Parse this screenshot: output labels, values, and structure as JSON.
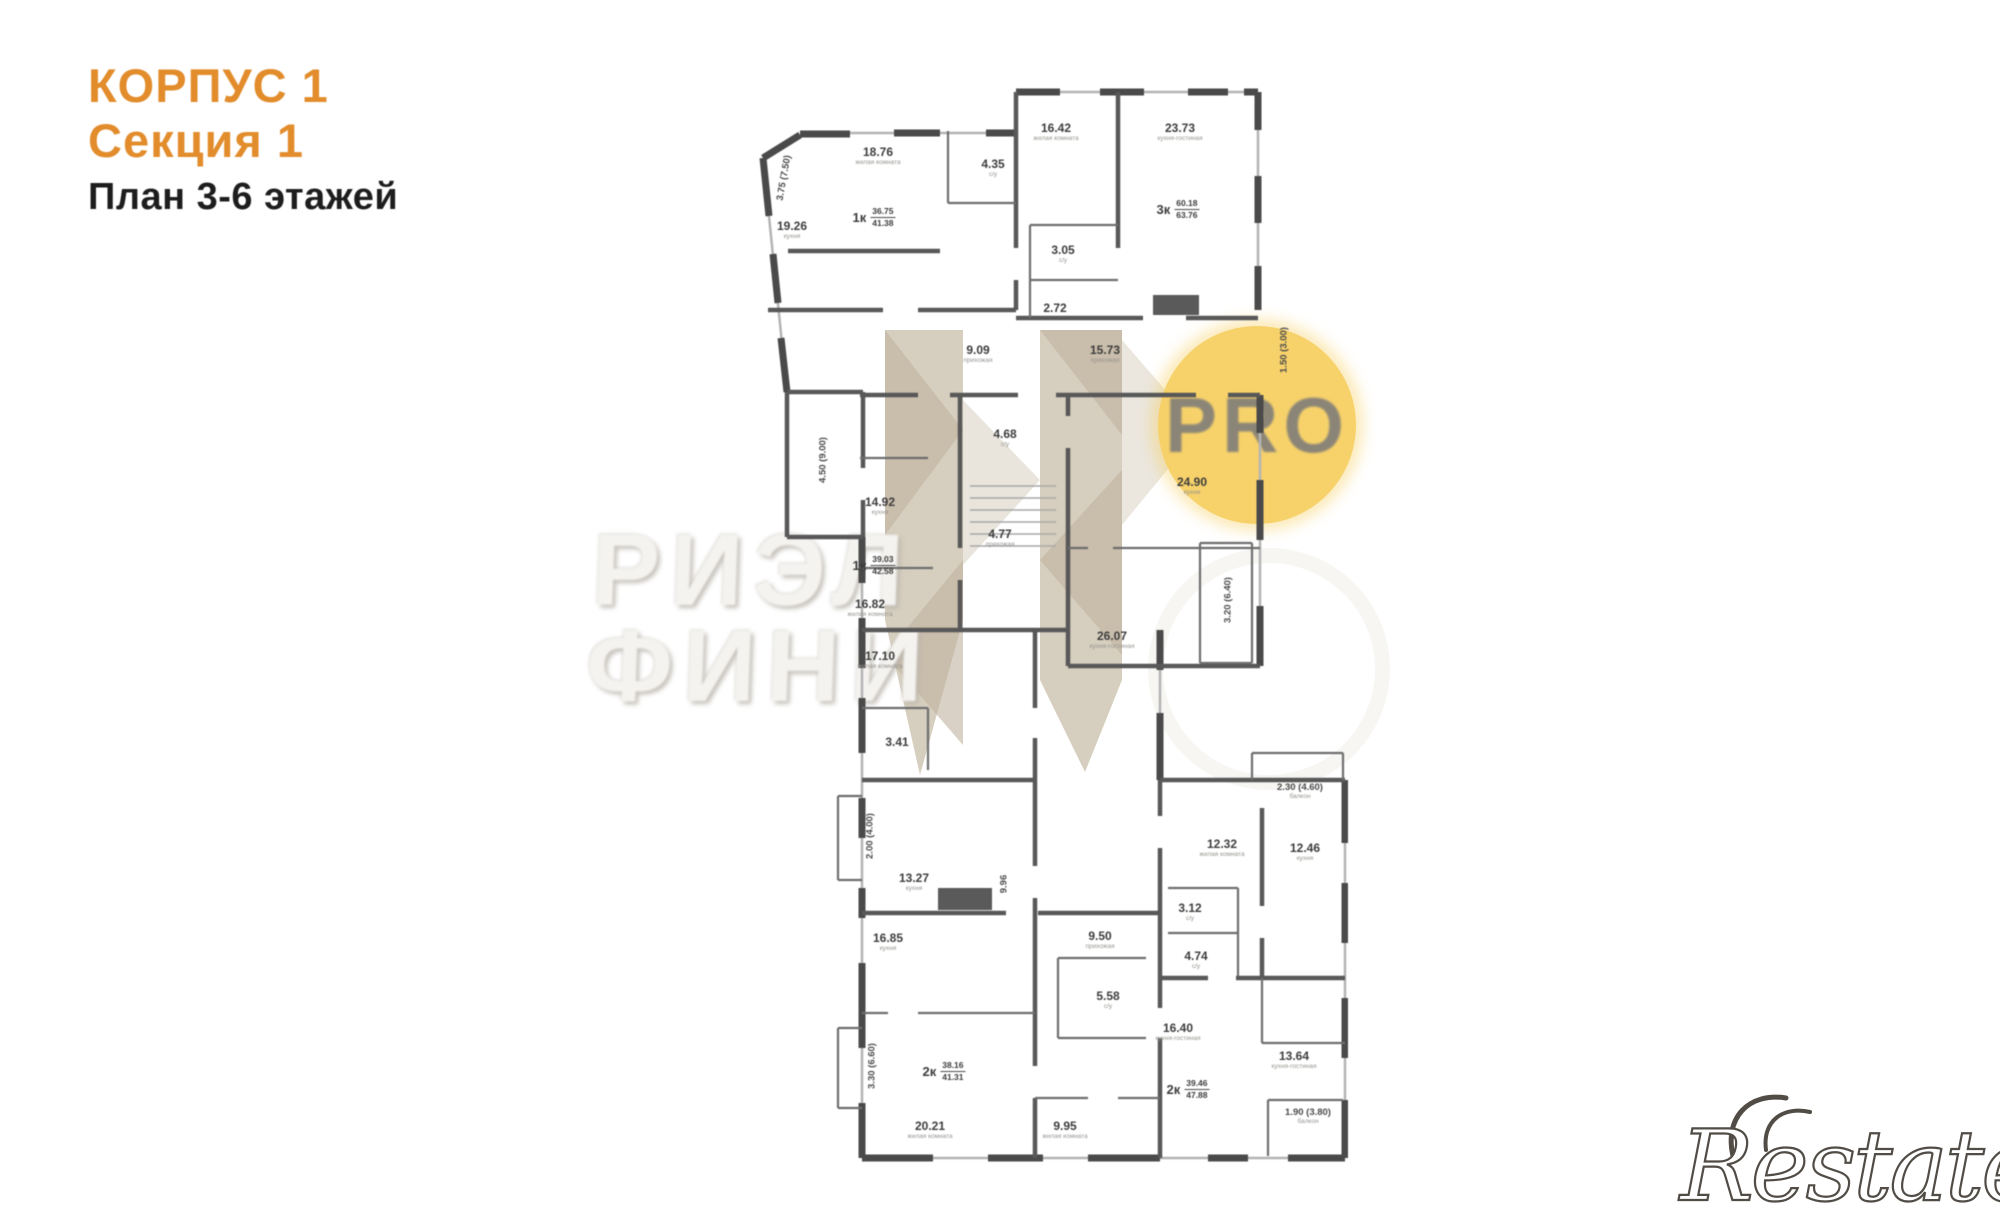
{
  "header": {
    "building": "КОРПУС 1",
    "section": "Секция 1",
    "plan_title": "План 3-6 этажей"
  },
  "watermarks": {
    "agency_line1": "РИЭЛ",
    "agency_line2": "ФИНИ",
    "pro": "PRO",
    "brand": "Restate"
  },
  "colors": {
    "accent_orange": "#e28c2b",
    "title_dark": "#1d1d1d",
    "pro_circle": "#f6ce5e",
    "pro_text": "#8b8577",
    "wall_gray": "#4a4a4a",
    "beige_watermark": "#cfc5b3",
    "brand_gray": "#514c46"
  },
  "plan": {
    "rooms": [
      {
        "label": "18.76",
        "caption": "жилая комната",
        "x": 290,
        "y": 138
      },
      {
        "label": "4.35",
        "caption": "с/у",
        "x": 405,
        "y": 150
      },
      {
        "label": "19.26",
        "caption": "кухня",
        "x": 204,
        "y": 212
      },
      {
        "label": "9.09",
        "caption": "прихожая",
        "x": 390,
        "y": 336
      },
      {
        "label": "16.42",
        "caption": "жилая комната",
        "x": 468,
        "y": 114
      },
      {
        "label": "23.73",
        "caption": "кухня-гостиная",
        "x": 592,
        "y": 114
      },
      {
        "label": "3.05",
        "caption": "с/у",
        "x": 475,
        "y": 236
      },
      {
        "label": "2.72",
        "caption": "",
        "x": 467,
        "y": 294
      },
      {
        "label": "15.73",
        "caption": "прихожая",
        "x": 517,
        "y": 336
      },
      {
        "label": "4.68",
        "caption": "с/у",
        "x": 417,
        "y": 420
      },
      {
        "label": "14.92",
        "caption": "кухня",
        "x": 292,
        "y": 488
      },
      {
        "label": "4.77",
        "caption": "прихожая",
        "x": 412,
        "y": 520
      },
      {
        "label": "16.82",
        "caption": "жилая комната",
        "x": 282,
        "y": 590
      },
      {
        "label": "17.10",
        "caption": "жилая комната",
        "x": 292,
        "y": 642
      },
      {
        "label": "3.41",
        "caption": "",
        "x": 309,
        "y": 728
      },
      {
        "label": "26.07",
        "caption": "кухня-гостиная",
        "x": 524,
        "y": 622
      },
      {
        "label": "24.90",
        "caption": "кухня",
        "x": 604,
        "y": 468
      },
      {
        "label": "13.27",
        "caption": "кухня",
        "x": 326,
        "y": 864
      },
      {
        "label": "16.85",
        "caption": "кухня",
        "x": 300,
        "y": 924
      },
      {
        "label": "20.21",
        "caption": "жилая комната",
        "x": 342,
        "y": 1112
      },
      {
        "label": "9.50",
        "caption": "прихожая",
        "x": 512,
        "y": 922
      },
      {
        "label": "5.58",
        "caption": "с/у",
        "x": 520,
        "y": 982
      },
      {
        "label": "9.95",
        "caption": "жилая комната",
        "x": 477,
        "y": 1112
      },
      {
        "label": "12.32",
        "caption": "жилая комната",
        "x": 634,
        "y": 830
      },
      {
        "label": "12.46",
        "caption": "кухня",
        "x": 717,
        "y": 834
      },
      {
        "label": "3.12",
        "caption": "с/у",
        "x": 602,
        "y": 894
      },
      {
        "label": "4.74",
        "caption": "с/у",
        "x": 608,
        "y": 942
      },
      {
        "label": "16.40",
        "caption": "кухня-гостиная",
        "x": 590,
        "y": 1014
      },
      {
        "label": "13.64",
        "caption": "кухня-гостиная",
        "x": 706,
        "y": 1042
      }
    ],
    "apartments": [
      {
        "type": "1к",
        "upper": "36.75",
        "lower": "41.38",
        "x": 286,
        "y": 198
      },
      {
        "type": "3к",
        "upper": "60.18",
        "lower": "63.76",
        "x": 590,
        "y": 190
      },
      {
        "type": "1к",
        "upper": "39.03",
        "lower": "42.58",
        "x": 286,
        "y": 546
      },
      {
        "type": "2к",
        "upper": "38.16",
        "lower": "41.31",
        "x": 356,
        "y": 1052
      },
      {
        "type": "2к",
        "upper": "39.46",
        "lower": "47.88",
        "x": 600,
        "y": 1070
      }
    ],
    "dimensions": [
      {
        "label": "3.75 (7.50)",
        "x": 196,
        "y": 170,
        "rot": -80
      },
      {
        "label": "4.50 (9.00)",
        "x": 235,
        "y": 452,
        "rot": -90
      },
      {
        "label": "1.50 (3.00)",
        "x": 696,
        "y": 342,
        "rot": -90
      },
      {
        "label": "3.20 (6.40)",
        "x": 640,
        "y": 592,
        "rot": -90
      },
      {
        "label": "2.00 (4.00)",
        "x": 282,
        "y": 828,
        "rot": -90
      },
      {
        "label": "3.30 (6.60)",
        "x": 284,
        "y": 1058,
        "rot": -90
      },
      {
        "label": "9.96",
        "x": 416,
        "y": 876,
        "rot": -90
      },
      {
        "label": "2.30 (4.60)",
        "caption": "балкон",
        "x": 712,
        "y": 783,
        "rot": 0
      },
      {
        "label": "1.90 (3.80)",
        "caption": "балкон",
        "x": 720,
        "y": 1108,
        "rot": 0
      }
    ]
  }
}
